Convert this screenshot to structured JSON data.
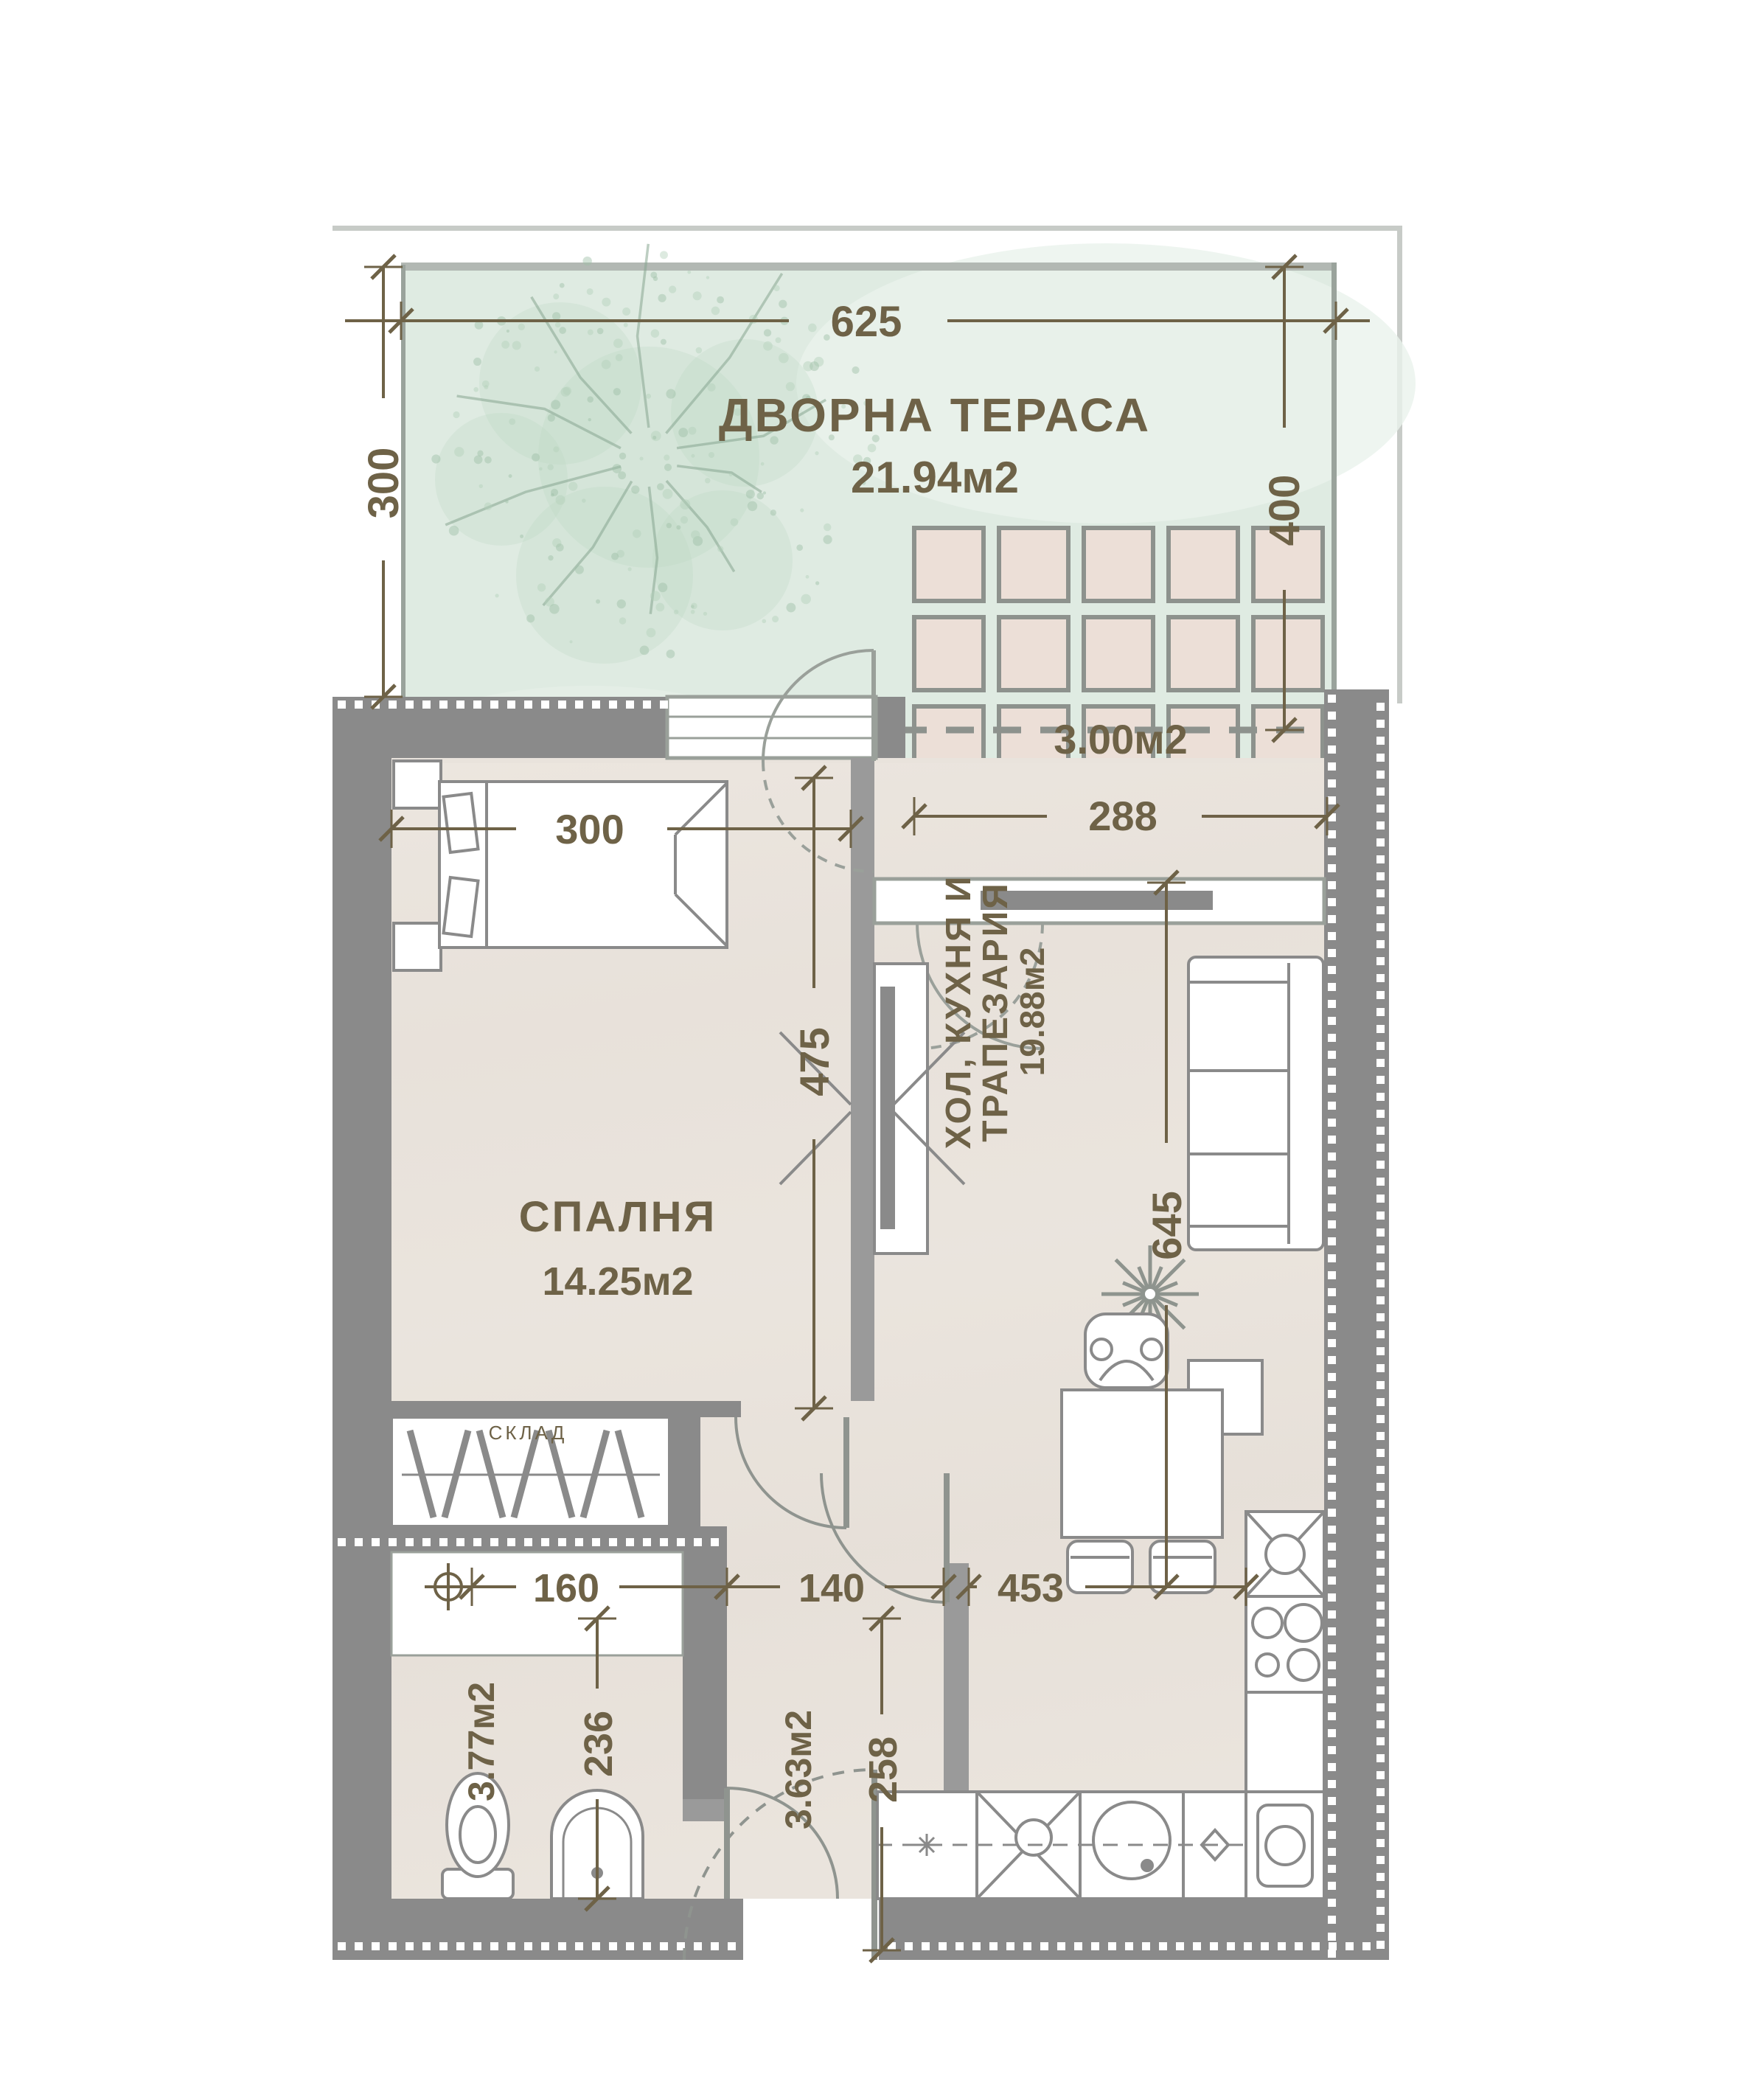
{
  "meta": {
    "type": "apartment floor plan",
    "language": "Bulgarian",
    "colors": {
      "wall": "#8a8a8a",
      "partition": "#9a9a9a",
      "ink": "#6e6247",
      "terrace_green": "#dfebe2",
      "floor_beige": "#e9e3dc",
      "tile_fill": "#ecdfd7",
      "frame_gray": "#9aa09a",
      "outer_line": "#c7cbc7"
    }
  },
  "terrace": {
    "name": "ДВОРНА ТЕРАСА",
    "area": "21.94м2",
    "dim_width": "625",
    "dim_depth": "300"
  },
  "patio": {
    "area": "3.00м2",
    "dim_width": "288",
    "dim_depth": "400"
  },
  "bedroom": {
    "name": "СПАЛНЯ",
    "area": "14.25м2",
    "dim_width": "300",
    "dim_depth": "475"
  },
  "living": {
    "name_line1": "ХОЛ, КУХНЯ И",
    "name_line2": "ТРАПЕЗАРИЯ",
    "area": "19.88м2",
    "dim_depth": "645",
    "dim_width": "453"
  },
  "bathroom": {
    "area": "3.77м2",
    "dim_width": "160",
    "dim_depth": "236"
  },
  "hallway": {
    "area": "3.63м2",
    "dim_width": "140",
    "dim_depth": "258"
  },
  "closet": {
    "label": "СКЛАД"
  }
}
